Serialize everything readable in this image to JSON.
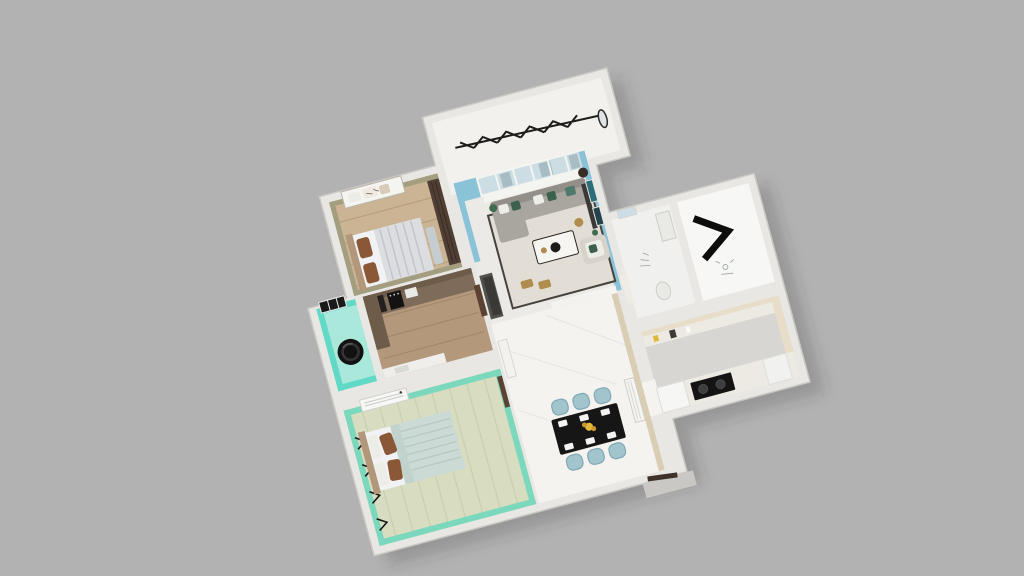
{
  "scene": {
    "kind": "3d-dollhouse-floorplan-render",
    "view": "top-down rotated",
    "rotation_deg": -15,
    "background": "#b2b2b2"
  },
  "rooms": [
    {
      "id": "balcony",
      "features": [
        "clothes-drying-rack",
        "standing-mirror"
      ]
    },
    {
      "id": "living-room",
      "features": [
        "french-window-partition",
        "sofa",
        "green-pillows",
        "coffee-table",
        "armchair",
        "wall-art",
        "floor-lamp",
        "rug",
        "side-stools"
      ]
    },
    {
      "id": "small-bedroom",
      "features": [
        "bed",
        "brown-pillows",
        "dark-wardrobe",
        "window-shelf",
        "bench"
      ]
    },
    {
      "id": "kitchen",
      "features": [
        "brown-cabinets",
        "black-appliances",
        "microwave",
        "white-counter",
        "door"
      ]
    },
    {
      "id": "laundry",
      "features": [
        "washing-machine",
        "dark-window"
      ]
    },
    {
      "id": "master-bedroom",
      "features": [
        "double-bed",
        "brown-pillows",
        "ac-shelf",
        "wall-sconces",
        "door"
      ]
    },
    {
      "id": "dining-hall",
      "features": [
        "black-dining-table",
        "six-blue-chairs",
        "place-settings",
        "yellow-flowers",
        "radiator-panel",
        "shoe-cabinet",
        "hall-cabinet",
        "entry-door",
        "entry-step"
      ]
    },
    {
      "id": "bathroom",
      "features": [
        "window",
        "toilet",
        "sink-counter",
        "door"
      ]
    },
    {
      "id": "entry-room",
      "features": [
        "black-console-chevron",
        "sketch-fixture"
      ]
    },
    {
      "id": "second-kitchen",
      "features": [
        "beige-counter",
        "black-cooktop",
        "white-cabinet",
        "fridge"
      ]
    }
  ],
  "colors": {
    "bg": "#b2b2b2",
    "shadow": "rgba(50,50,50,0.22)",
    "wall_outer": "#e8e7e3",
    "wall_stroke": "#c9c8c4",
    "wall_inner": "#f4f3f0",
    "balcony_floor": "#f2f1ed",
    "rack_black": "#1d1d1b",
    "living_wall": "#8ac3d8",
    "living_floor": "#eceae6",
    "window_glass": "#ccdee4",
    "window_frame": "#f4f4f1",
    "glass_dark": "#a7bcc3",
    "rug": "#e3ded5",
    "rug_border": "#45423c",
    "sofa": "#a8a69e",
    "sofa_dark": "#918f88",
    "pillow_white": "#edede8",
    "pillow_green": "#3b614d",
    "pillow_teal": "#4e7a6e",
    "table_white": "#f6f5f1",
    "bowl_black": "#1c1c1a",
    "gold": "#b08d4f",
    "armchair": "#d7d3ca",
    "art_teal": "#2d6d77",
    "art_dark": "#24444b",
    "lamp_dark": "#3a2f26",
    "plant_green": "#3f6b4e",
    "b1_wall": "#a49e80",
    "b1_floor": "#cbb494",
    "b1_floor_line": "#b29a7d",
    "wardrobe": "#4f3e33",
    "b1_duvet": "#dcdde1",
    "b1_stripe": "#c1c5cb",
    "mattress": "#f1f2f4",
    "headboard": "#b2977b",
    "pillow_brown": "#8a5737",
    "bench_gray": "#c6cdd1",
    "k_floor": "#b4987b",
    "k_floor_line": "#a1856a",
    "cab_brown": "#7e6b59",
    "cab_brown2": "#6e5c4b",
    "appliance": "#24201d",
    "micro_white": "#e9e9e6",
    "counter": "#efeeea",
    "door_brown": "#5b4232",
    "l_wall": "#62d9c6",
    "l_floor": "#a9e8da",
    "washer": "#121212",
    "washer_ring": "#343434",
    "win_dark": "#1a1a1a",
    "m_wall": "#7bd8bc",
    "m_floor": "#d8dcc1",
    "m_floor_line": "#c6cdaa",
    "b2_duvet": "#ccdad6",
    "b2_quilt": "#b7c8c3",
    "ac_white": "#f7f7f5",
    "sconce": "#161616",
    "d_floor": "#f4f3ef",
    "beige": "#d9cdb3",
    "beige2": "#e7ddc8",
    "chair": "#a2c5cd",
    "chair_stroke": "#7fa9b4",
    "d_table": "#161616",
    "plate": "#f3f3f1",
    "flower": "#e2b83b",
    "flower2": "#c9992b",
    "radiator": "#f4f4f1",
    "hall_cab": "#f3f2ee",
    "shoe_cab": "#53514d",
    "shoe_cab2": "#3b3936",
    "bath_floor": "#f0f0ee",
    "fixture": "#e9e9e6",
    "fixture_stroke": "#cdcdc9",
    "entry_floor": "#f7f7f5",
    "chevron": "#0d0d0d",
    "k2_floor": "#d7d6d2",
    "k2_counter": "#eceae2",
    "cooktop": "#141414",
    "burner": "#3d3d3d",
    "white_cab": "#f6f6f4",
    "step_gray": "#c9c8c5",
    "door_dark": "#3e3129"
  }
}
